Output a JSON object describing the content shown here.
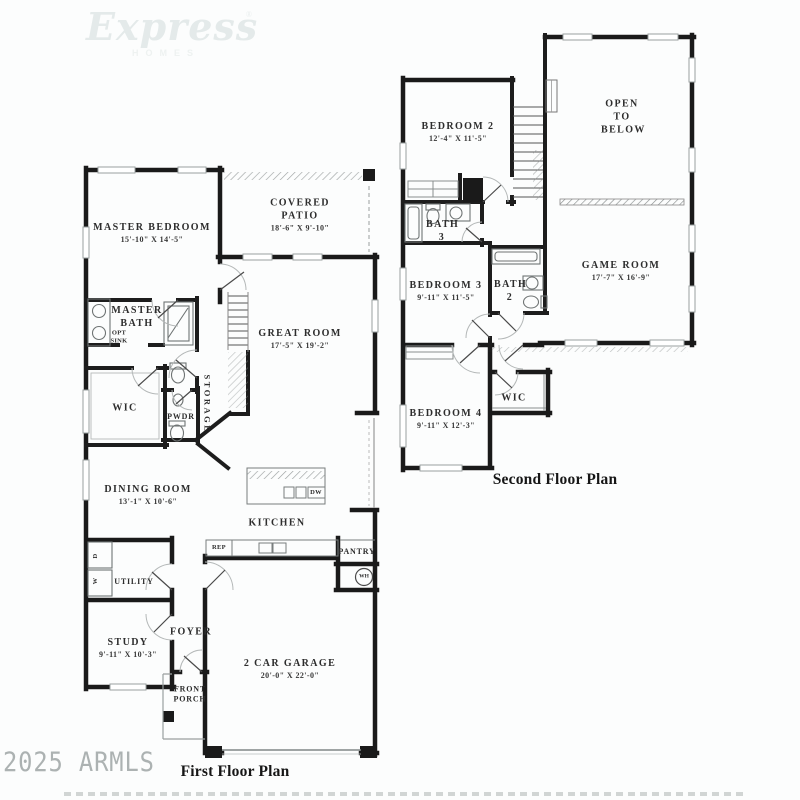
{
  "branding": {
    "logo_script": "Express",
    "logo_sub": "HOMES",
    "registered": "®"
  },
  "watermark": {
    "armls": "2025 ARMLS"
  },
  "floor1": {
    "title": "First Floor Plan",
    "rooms": {
      "master_bedroom": {
        "name": "MASTER BEDROOM",
        "dims": "15'-10\" X 14'-5\""
      },
      "covered_patio": {
        "name": "COVERED PATIO",
        "dims": "18'-6\" X 9'-10\""
      },
      "great_room": {
        "name": "GREAT ROOM",
        "dims": "17'-5\" X 19'-2\""
      },
      "master_bath": {
        "name": "MASTER BATH"
      },
      "opt_sink": {
        "name": "OPT SINK"
      },
      "wic": {
        "name": "WIC"
      },
      "storage": {
        "name": "STORAGE"
      },
      "pwdr": {
        "name": "PWDR"
      },
      "dining_room": {
        "name": "DINING ROOM",
        "dims": "13'-1\" X 10'-6\""
      },
      "kitchen": {
        "name": "KITCHEN"
      },
      "rep": {
        "name": "REP"
      },
      "dw": {
        "name": "DW"
      },
      "pantry": {
        "name": "PANTRY"
      },
      "wh": {
        "name": "WH"
      },
      "utility": {
        "name": "UTILITY"
      },
      "dryer": {
        "name": "D"
      },
      "washer": {
        "name": "W"
      },
      "study": {
        "name": "STUDY",
        "dims": "9'-11\" X 10'-3\""
      },
      "foyer": {
        "name": "FOYER"
      },
      "front_porch": {
        "name": "FRONT PORCH"
      },
      "garage": {
        "name": "2 CAR GARAGE",
        "dims": "20'-0\" X 22'-0\""
      }
    }
  },
  "floor2": {
    "title": "Second Floor Plan",
    "rooms": {
      "bedroom2": {
        "name": "BEDROOM 2",
        "dims": "12'-4\" X 11'-5\""
      },
      "open_to_below": {
        "name": "OPEN TO BELOW"
      },
      "bath3": {
        "name": "BATH 3"
      },
      "bedroom3": {
        "name": "BEDROOM 3",
        "dims": "9'-11\" X 11'-5\""
      },
      "bath2": {
        "name": "BATH 2"
      },
      "game_room": {
        "name": "GAME ROOM",
        "dims": "17'-7\" X 16'-9\""
      },
      "wic": {
        "name": "WIC"
      },
      "bedroom4": {
        "name": "BEDROOM 4",
        "dims": "9'-11\" X 12'-3\""
      }
    }
  }
}
